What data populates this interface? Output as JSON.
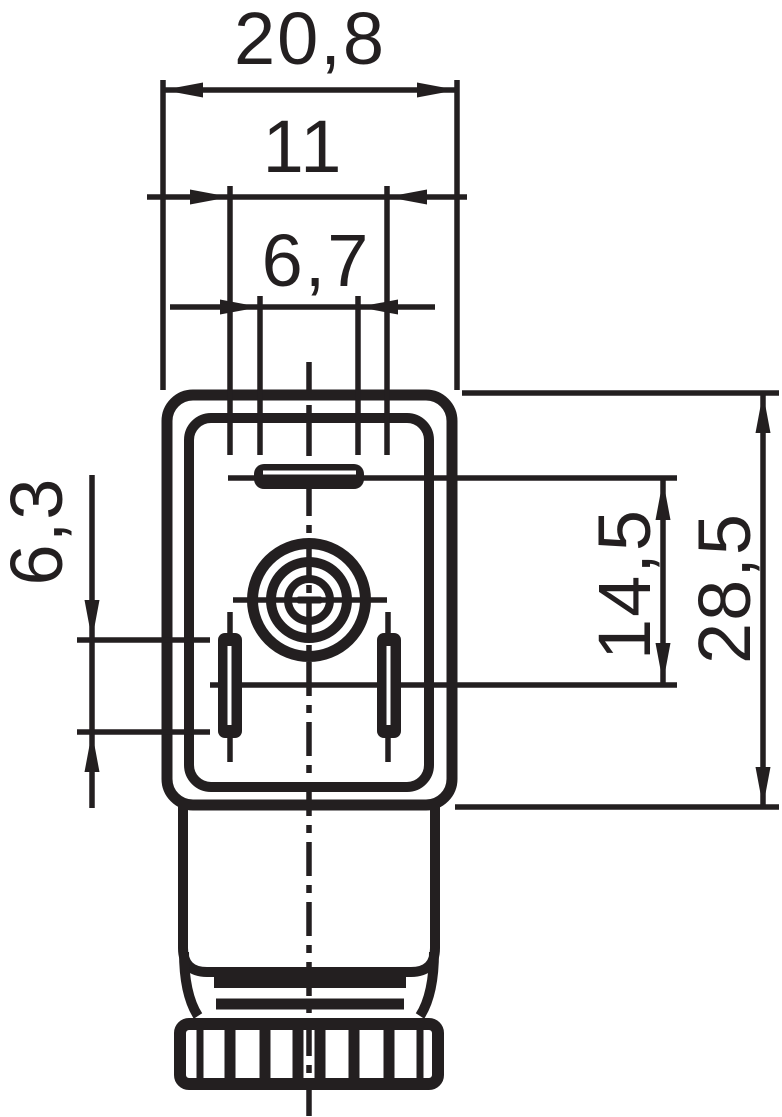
{
  "drawing": {
    "background": "#ffffff",
    "ink": "#231f20",
    "dimension_labels": {
      "outer_width": "20,8",
      "contact_spacing": "11",
      "center_slot_width": "6,7",
      "side_slot_length": "6,3",
      "contact_field_height": "14,5",
      "body_height": "28,5"
    }
  }
}
